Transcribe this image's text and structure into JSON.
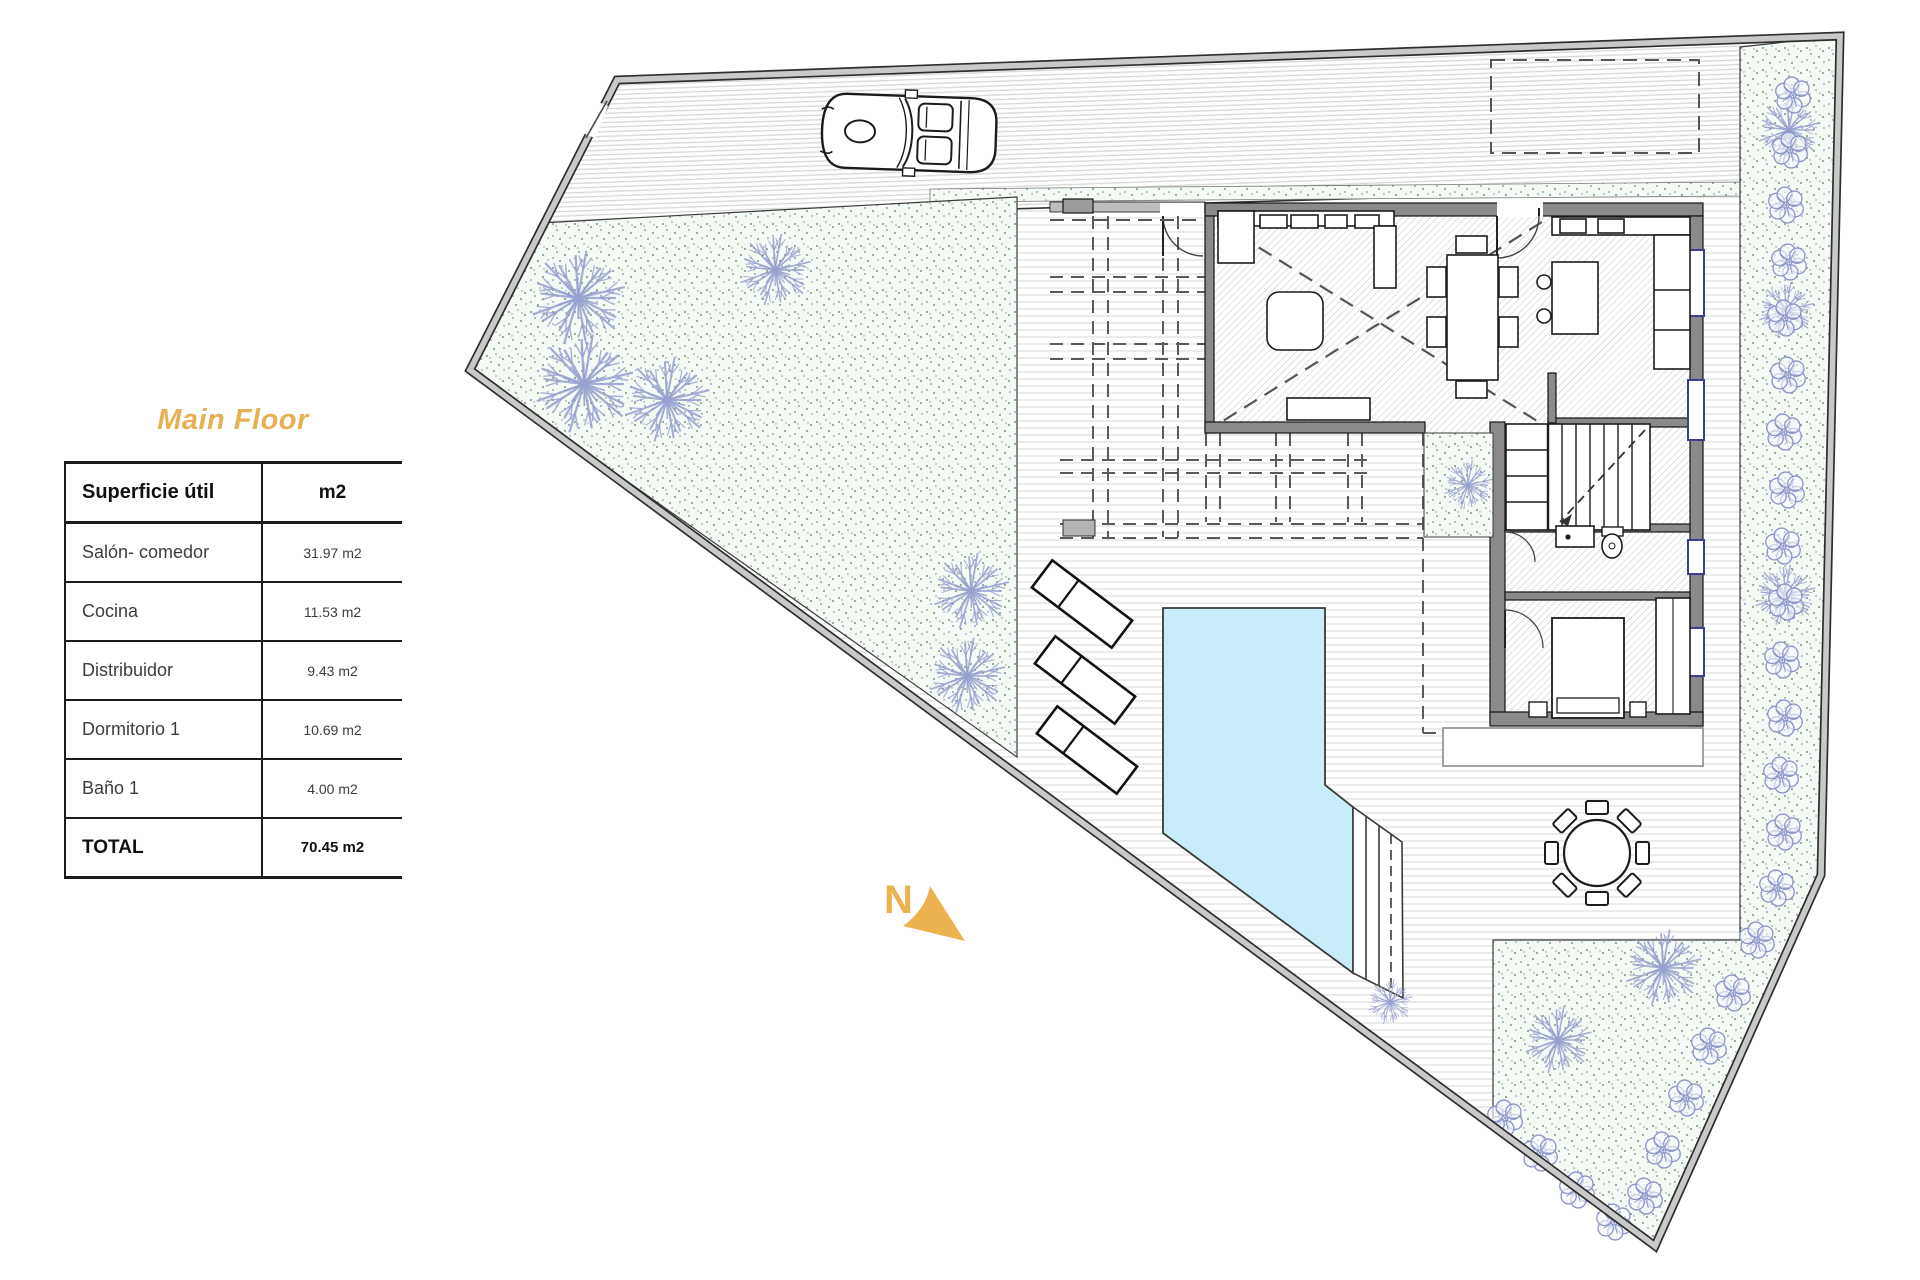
{
  "legend": {
    "title": "Main Floor",
    "title_color": "#E8B054",
    "table": {
      "header_label": "Superficie útil",
      "header_unit": "m2",
      "rows": [
        {
          "label": "Salón- comedor",
          "value": "31.97 m2"
        },
        {
          "label": "Cocina",
          "value": "11.53 m2"
        },
        {
          "label": "Distribuidor",
          "value": "9.43 m2"
        },
        {
          "label": "Dormitorio 1",
          "value": "10.69 m2"
        },
        {
          "label": "Baño 1",
          "value": "4.00 m2"
        }
      ],
      "total": {
        "label": "TOTAL",
        "value": "70.45 m2"
      }
    }
  },
  "compass": {
    "label": "N",
    "color": "#EDB250"
  },
  "plan": {
    "pool_color": "#C9EDF8",
    "boundary_color": "#9e9e9e",
    "wall_color": "#8a8a8a",
    "garden_dot_color": "#8fa796",
    "tree_color": "#97a0cf",
    "bush_color": "#8b95c9"
  }
}
